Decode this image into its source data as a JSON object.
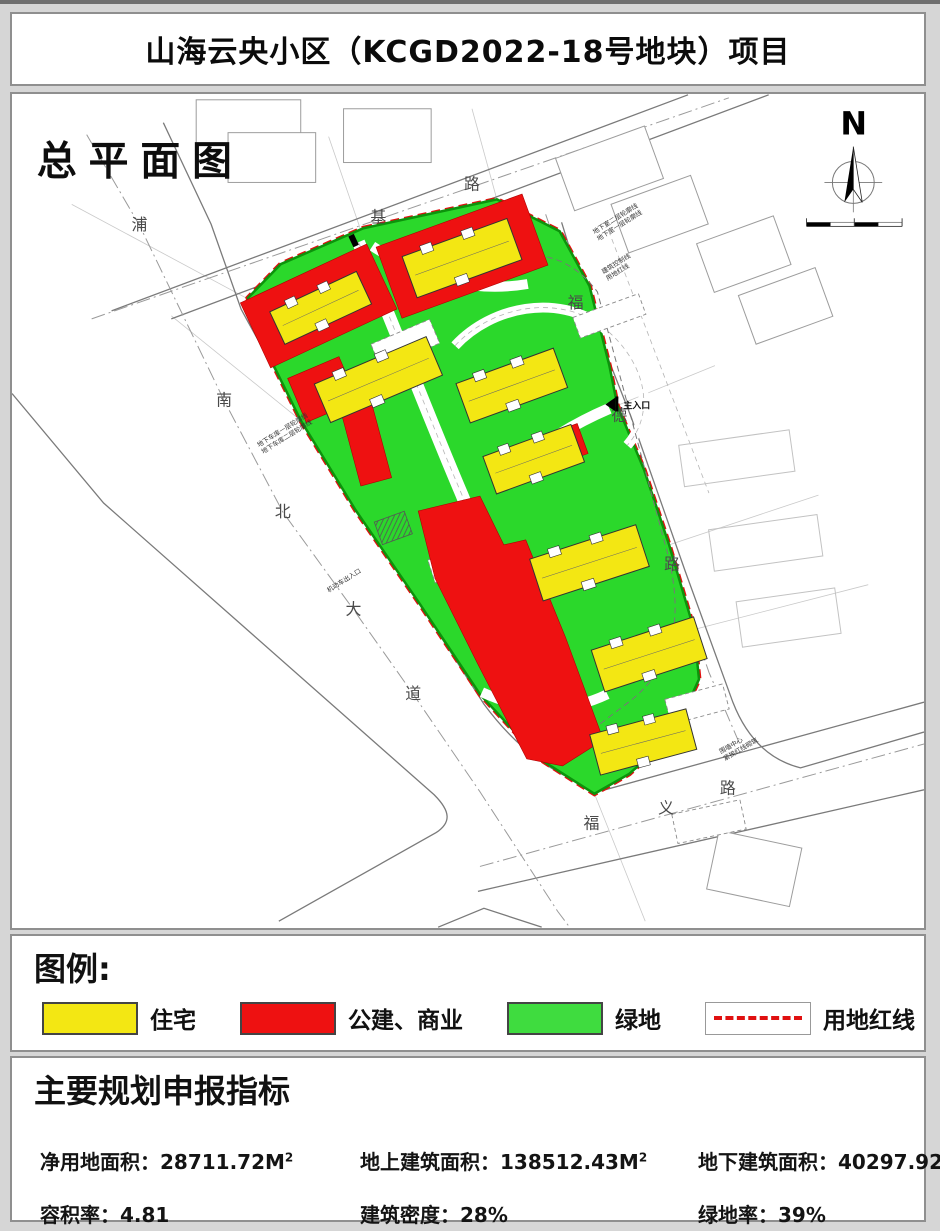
{
  "title": "山海云央小区（KCGD2022-18号地块）项目",
  "map": {
    "label": "总平面图",
    "north_letter": "N",
    "roads": {
      "left": [
        "浦",
        "南",
        "北",
        "大",
        "道"
      ],
      "top": [
        "基",
        "路"
      ],
      "right": [
        "福",
        "德",
        "路"
      ],
      "bottom": [
        "福",
        "义",
        "路"
      ]
    },
    "entrance": "主入口",
    "annotations": {
      "basement2": "地下室二层轮廓线",
      "basement1": "地下室一层轮廓线",
      "control_line": "建筑控制线",
      "red_line": "用地红线",
      "garage1": "地下车库一层轮廓线",
      "garage2": "地下车库二层轮廓线",
      "garage_entry": "机动车出入口",
      "wall1": "围墙中心",
      "wall2": "紧挨红线砌筑"
    },
    "colors": {
      "residential": "#f3e713",
      "public_commercial": "#ee1111",
      "green_space": "#2bd82b",
      "land_red_line": "#e01010"
    }
  },
  "legend": {
    "heading": "图例:",
    "items": [
      {
        "label": "住宅",
        "color": "#f3e713"
      },
      {
        "label": "公建、商业",
        "color": "#ee1111"
      },
      {
        "label": "绿地",
        "color": "#3fdc3f"
      },
      {
        "label": "用地红线",
        "color": "#e01010"
      },
      {
        "label": "道路红线",
        "color": "#9a9a9a"
      }
    ]
  },
  "indicators": {
    "heading": "主要规划申报指标",
    "rows": [
      [
        {
          "text": "净用地面积：28711.72M",
          "sup": "2"
        },
        {
          "text": "地上建筑面积：138512.43M",
          "sup": "2"
        },
        {
          "text": "地下建筑面积：40297.92M",
          "sup": "2"
        }
      ],
      [
        {
          "text": "容积率：4.81",
          "sup": ""
        },
        {
          "text": "建筑密度：28%",
          "sup": ""
        },
        {
          "text": "绿地率：39%",
          "sup": ""
        }
      ]
    ]
  }
}
